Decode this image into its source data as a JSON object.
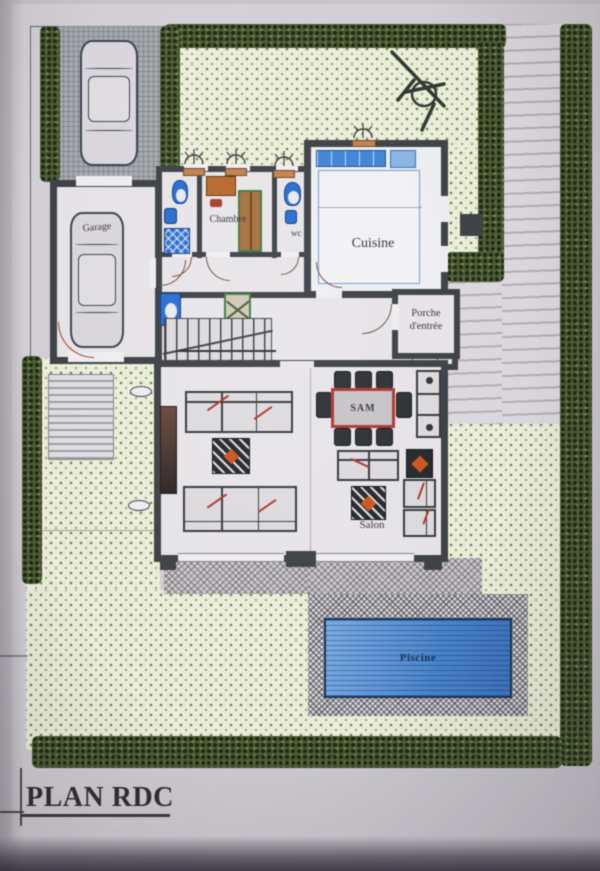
{
  "title": "PLAN RDC",
  "rooms": {
    "garage": "Garage",
    "chambre": "Chambre",
    "wc": "wc",
    "cuisine": "Cuisine",
    "porche_line1": "Porche",
    "porche_line2": "d'entrée",
    "sam": "SAM",
    "salon": "Salon",
    "piscine": "Piscine"
  },
  "colors": {
    "wall": "#3e4247",
    "hedge_green": "#4d5e34",
    "garden_dot_green": "#76884b",
    "pool_water_blue": "#4a86cf",
    "pool_border_blue": "#17345d",
    "fixture_blue": "#2a6fd4",
    "kitchen_counter_blue": "#3f86d8",
    "accent_red": "#b0392c",
    "wood_orange": "#c4824f",
    "label_ink": "#37353e"
  },
  "icons": {
    "car": "car-icon",
    "palm_tree": "palm-tree-icon",
    "toilet": "toilet-icon",
    "washbasin": "washbasin-icon",
    "shower": "shower-icon",
    "wardrobe": "wardrobe-icon",
    "desk": "desk-icon",
    "closet": "closet-icon",
    "stairs": "stairs-icon",
    "door_swing": "door-swing-icon",
    "ceiling_vent": "vent-icon",
    "dining_table": "dining-table-icon",
    "sofa": "sofa-icon",
    "coffee_table": "coffee-table-icon",
    "armchair": "armchair-icon",
    "light_fixture": "light-fixture-icon"
  }
}
